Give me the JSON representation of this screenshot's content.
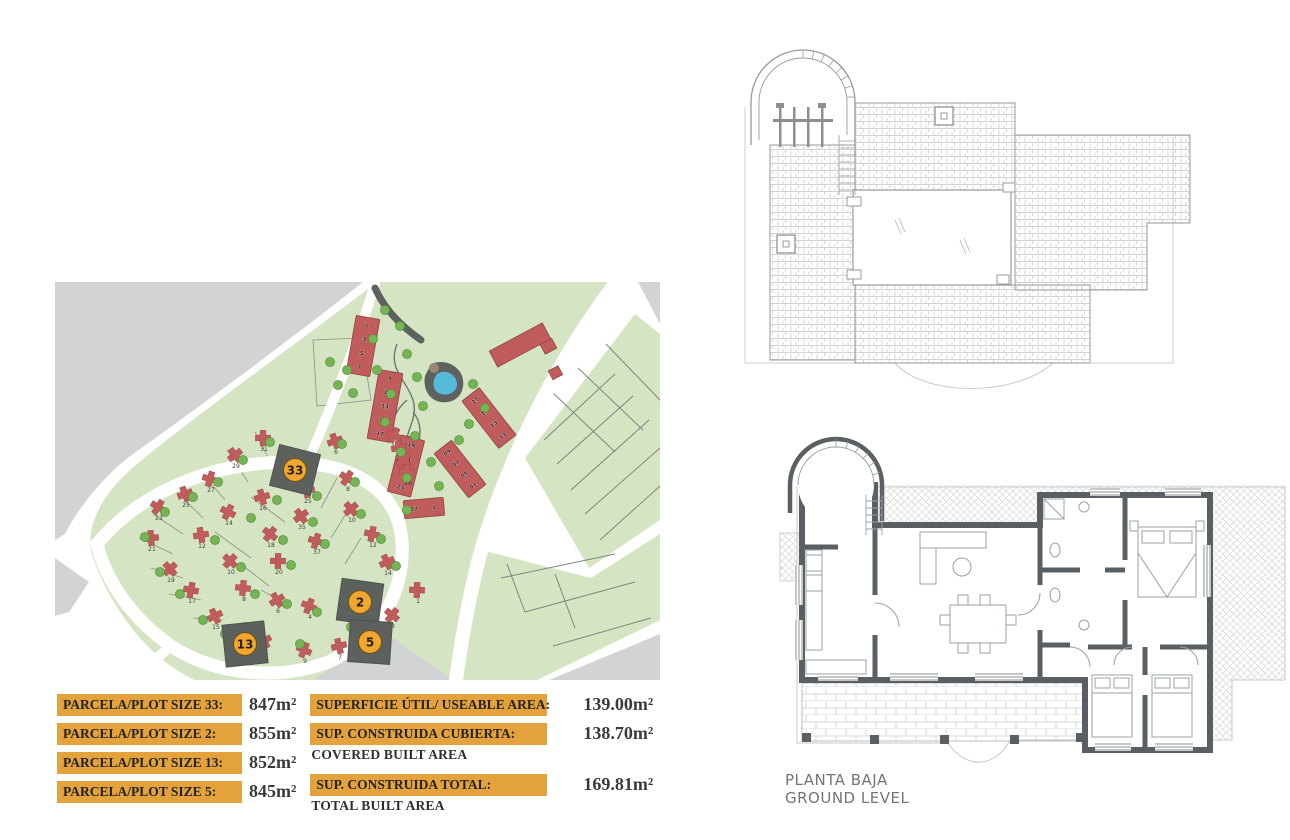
{
  "legend": {
    "plots": [
      {
        "label": "PARCELA/PLOT SIZE 33:",
        "value": "847m²"
      },
      {
        "label": "PARCELA/PLOT SIZE 2:",
        "value": "855m²"
      },
      {
        "label": "PARCELA/PLOT SIZE 13:",
        "value": "852m²"
      },
      {
        "label": "PARCELA/PLOT SIZE 5:",
        "value": "845m²"
      }
    ],
    "areas": [
      {
        "label": "SUPERFICIE ÚTIL/ USEABLE AREA:",
        "sublabel": "",
        "value": "139.00m²"
      },
      {
        "label": "SUP. CONSTRUIDA CUBIERTA:",
        "sublabel": "COVERED BUILT AREA",
        "value": "138.70m²"
      },
      {
        "label": "SUP. CONSTRUIDA TOTAL:",
        "sublabel": "TOTAL BUILT AREA",
        "value": "169.81m²"
      }
    ]
  },
  "ground_plan": {
    "title_line1": "PLANTA BAJA",
    "title_line2": "GROUND LEVEL"
  },
  "site_plan": {
    "highlighted_plots": [
      {
        "id": "33",
        "x": 240,
        "y": 188,
        "rot": 14
      },
      {
        "id": "2",
        "x": 305,
        "y": 320,
        "rot": 8
      },
      {
        "id": "13",
        "x": 190,
        "y": 362,
        "rot": -6
      },
      {
        "id": "5",
        "x": 315,
        "y": 360,
        "rot": 4
      }
    ],
    "apartment_blocks": [
      {
        "numbers": [
          "1",
          "3",
          "5",
          "7"
        ],
        "cx": 308,
        "cy": 64,
        "w": 24,
        "h": 58,
        "rot": 10,
        "horizontal": false
      },
      {
        "numbers": [
          "9",
          "11",
          "13",
          "15",
          "17"
        ],
        "cx": 330,
        "cy": 124,
        "w": 24,
        "h": 70,
        "rot": 10,
        "horizontal": false
      },
      {
        "numbers": [
          "19",
          "21",
          "23",
          "25"
        ],
        "cx": 351,
        "cy": 184,
        "w": 24,
        "h": 58,
        "rot": 14,
        "horizontal": false
      },
      {
        "numbers": [
          "17",
          "15",
          "13",
          "11"
        ],
        "cx": 434,
        "cy": 136,
        "w": 22,
        "h": 60,
        "rot": -38,
        "horizontal": false
      },
      {
        "numbers": [
          "09",
          "07",
          "05",
          "01"
        ],
        "cx": 405,
        "cy": 187,
        "w": 22,
        "h": 56,
        "rot": -38,
        "horizontal": false
      },
      {
        "numbers": [
          "27",
          "1"
        ],
        "cx": 369,
        "cy": 226,
        "w": 40,
        "h": 18,
        "rot": -5,
        "horizontal": true
      }
    ],
    "villa_plots": [
      {
        "n": "31",
        "x": 209,
        "y": 169
      },
      {
        "n": "29",
        "x": 181,
        "y": 186
      },
      {
        "n": "27",
        "x": 156,
        "y": 210
      },
      {
        "n": "25",
        "x": 131,
        "y": 225
      },
      {
        "n": "23",
        "x": 104,
        "y": 238
      },
      {
        "n": "21",
        "x": 97,
        "y": 269
      },
      {
        "n": "19",
        "x": 116,
        "y": 300
      },
      {
        "n": "17",
        "x": 137,
        "y": 321
      },
      {
        "n": "15",
        "x": 161,
        "y": 347
      },
      {
        "n": "14",
        "x": 174,
        "y": 243
      },
      {
        "n": "12",
        "x": 147,
        "y": 266
      },
      {
        "n": "10",
        "x": 176,
        "y": 292
      },
      {
        "n": "8",
        "x": 189,
        "y": 319
      },
      {
        "n": "6",
        "x": 223,
        "y": 331
      },
      {
        "n": "4",
        "x": 255,
        "y": 337
      },
      {
        "n": "16",
        "x": 208,
        "y": 228
      },
      {
        "n": "18",
        "x": 216,
        "y": 265
      },
      {
        "n": "20",
        "x": 224,
        "y": 292
      },
      {
        "n": "35",
        "x": 247,
        "y": 247
      },
      {
        "n": "37",
        "x": 262,
        "y": 272
      },
      {
        "n": "6",
        "x": 281,
        "y": 172
      },
      {
        "n": "8",
        "x": 293,
        "y": 209
      },
      {
        "n": "25",
        "x": 253,
        "y": 221
      },
      {
        "n": "10",
        "x": 297,
        "y": 240
      },
      {
        "n": "12",
        "x": 318,
        "y": 265
      },
      {
        "n": "14",
        "x": 333,
        "y": 293
      },
      {
        "n": "19",
        "x": 340,
        "y": 166
      },
      {
        "n": "21",
        "x": 345,
        "y": 179
      },
      {
        "n": "23",
        "x": 349,
        "y": 191
      },
      {
        "n": "26",
        "x": 353,
        "y": 203
      },
      {
        "n": "11",
        "x": 210,
        "y": 372
      },
      {
        "n": "9",
        "x": 250,
        "y": 381
      },
      {
        "n": "7",
        "x": 285,
        "y": 377
      },
      {
        "n": "3",
        "x": 338,
        "y": 346
      },
      {
        "n": "1",
        "x": 363,
        "y": 321
      }
    ],
    "colors": {
      "land_green": "#D5E4C3",
      "gray_area": "#D2D3D5",
      "house_red": "#C05C5C",
      "tree_green": "#76B556",
      "pool_blue": "#55BBDB",
      "dark_plot": "#5C615E",
      "badge_orange": "#EFA72F",
      "legend_box": "#E3A23B",
      "wall_gray": "#5A5F64"
    }
  }
}
